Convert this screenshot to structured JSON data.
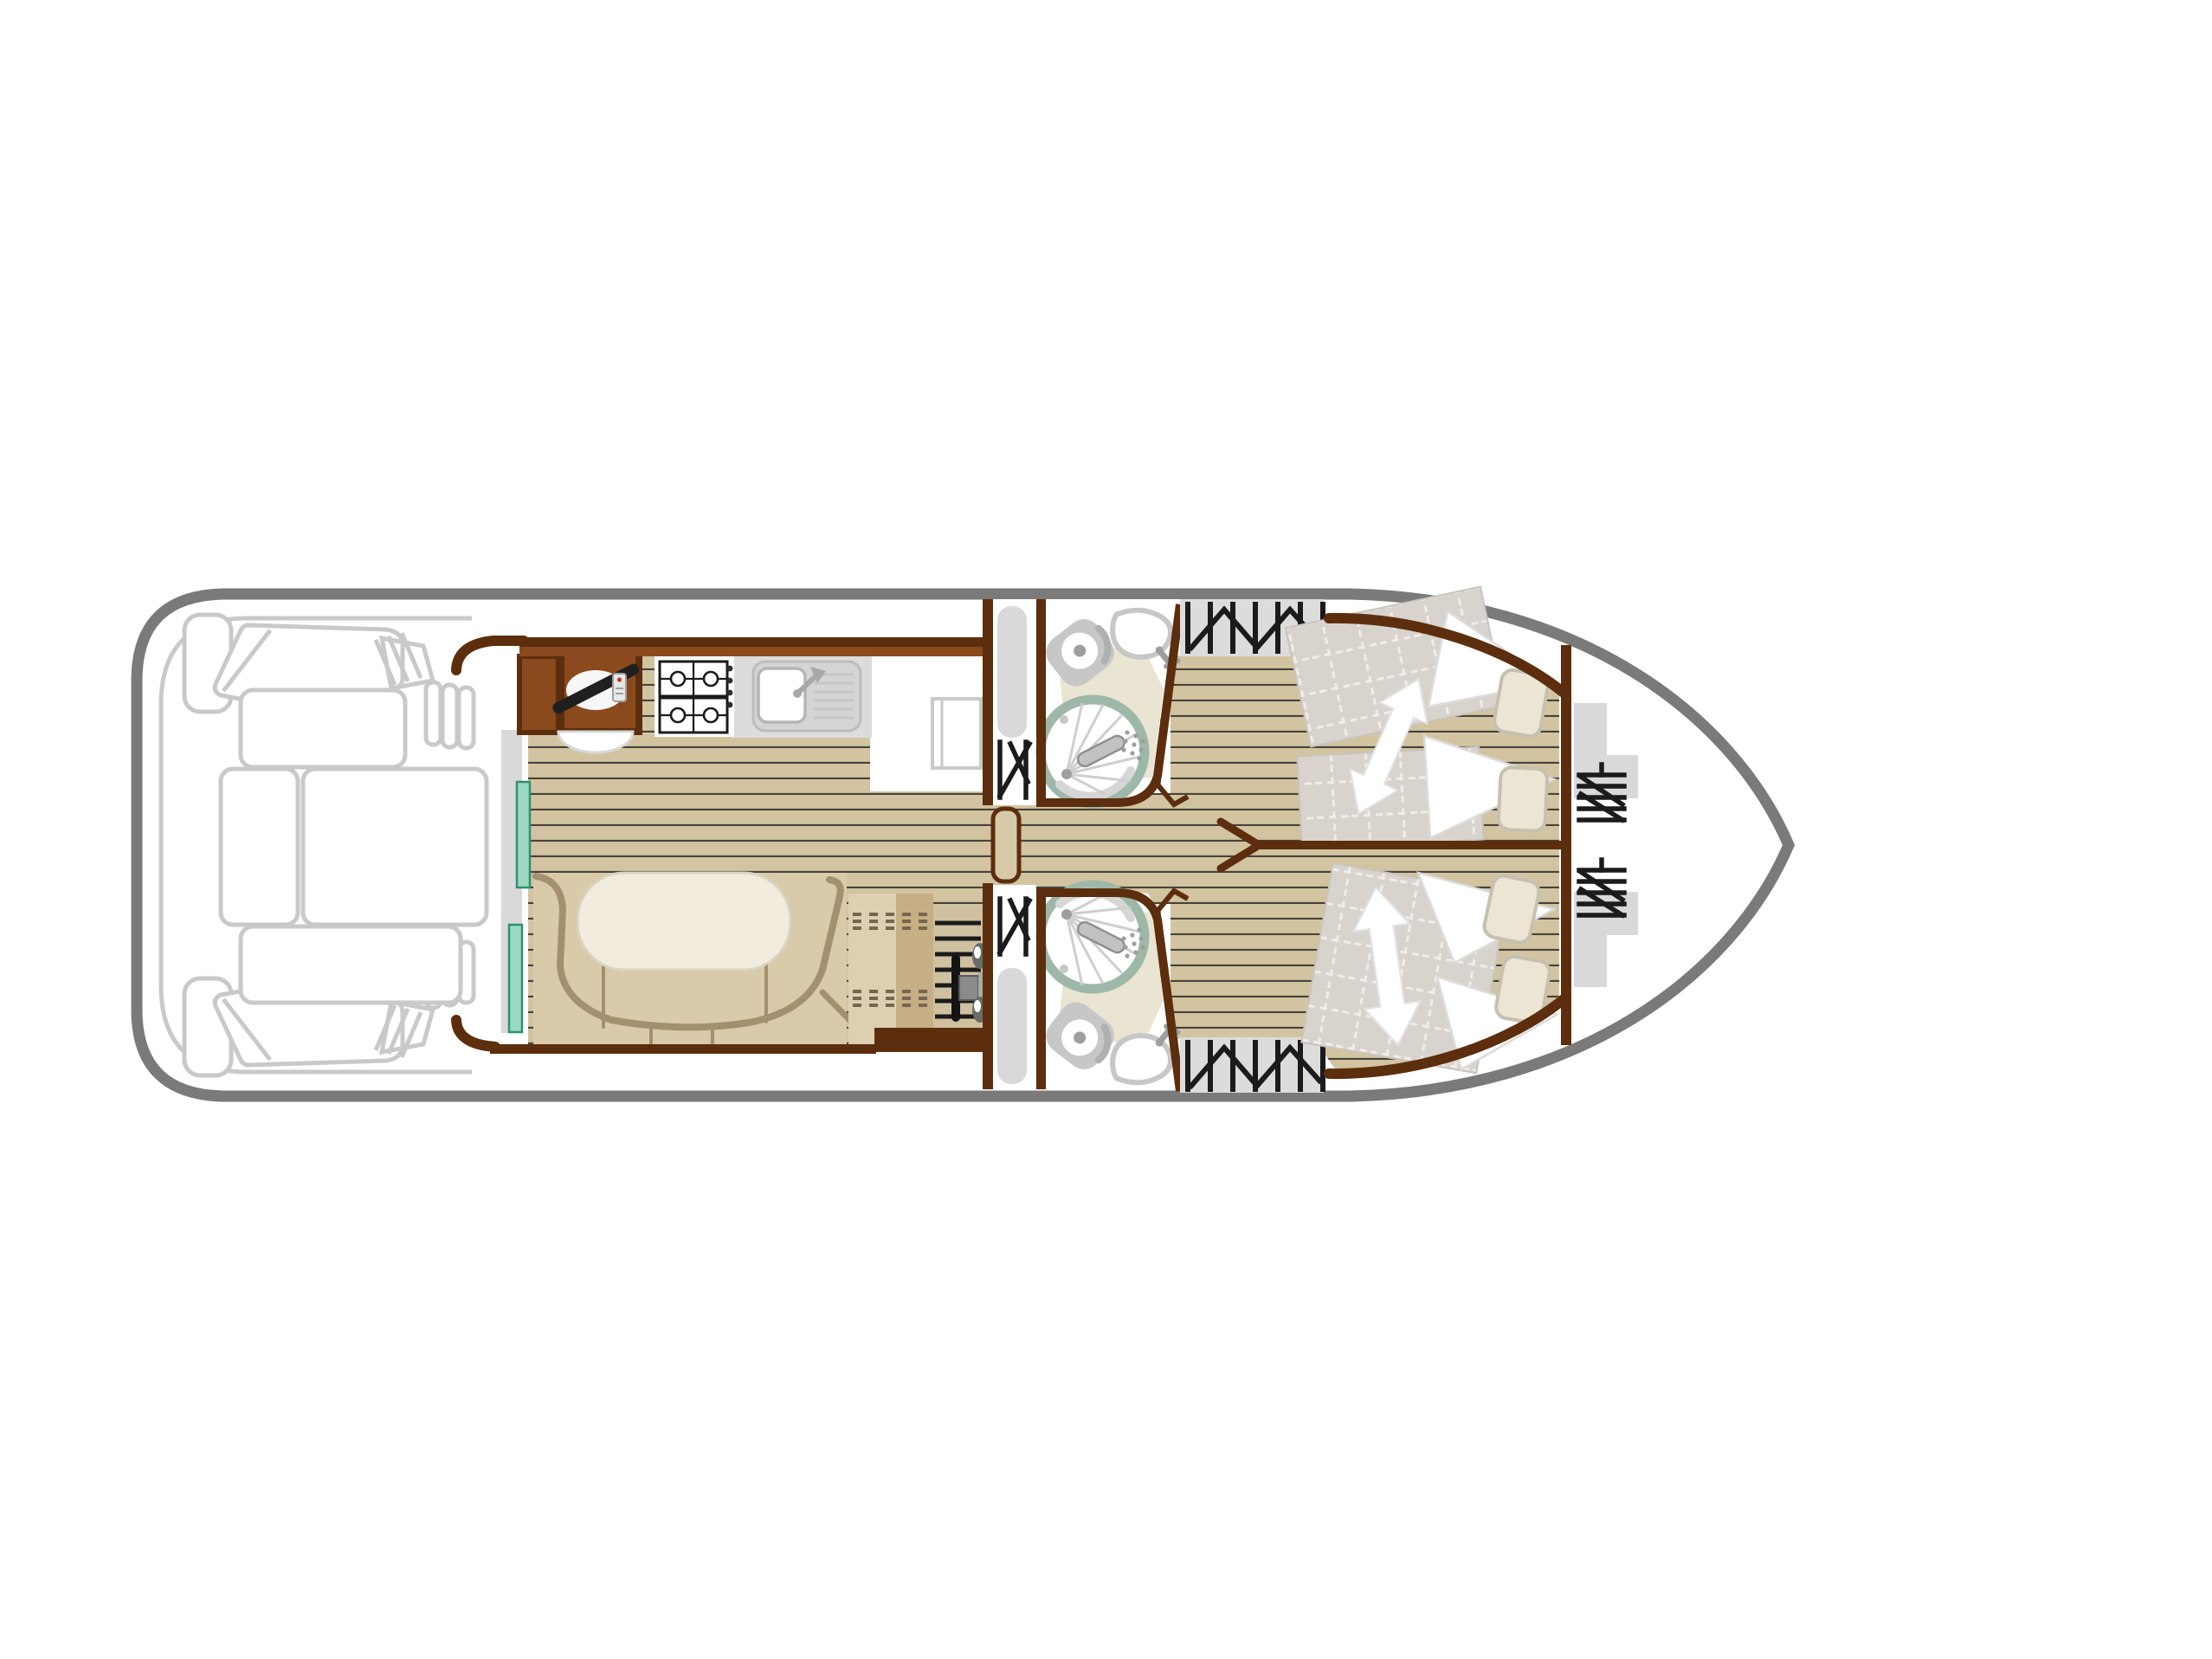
{
  "meta": {
    "title": "Canal boat deck floor plan — top-down layout, bow to the right",
    "type": "floor-plan-diagram",
    "orientation": {
      "bow": "right",
      "stern": "left"
    }
  },
  "colors": {
    "canvas": "#ffffff",
    "boat_fill": "#ffffff",
    "hull_outline": "#7a7a7a",
    "deck_outline": "#c9c9c9",
    "wall_brown": "#5c2e0d",
    "cabinet_brown": "#8a4a1e",
    "wood_floor": "#d3c4a1",
    "plank_line": "#45433a",
    "counter_gray": "#dcdcdc",
    "fixture_gray": "#c7c7c7",
    "fixture_gray_dark": "#9e9e9e",
    "shower_ring_sage": "#9db8a8",
    "shower_spoke": "#cfcfcf",
    "bath_patch_beige": "#eae4d2",
    "teal_door": "#9bd9c1",
    "teal_door_edge": "#2f8f76",
    "sofa_tan": "#d9caaa",
    "sofa_edge": "#a2906e",
    "table_cream": "#f1ecdd",
    "table_edge": "#d9d3c0",
    "sideboard_light": "#ddd0b2",
    "sideboard_dark": "#c7af85",
    "stitch_dash": "#74674f",
    "steps_bg": "#cfc0a0",
    "icon_black": "#1b1b1b",
    "mattress_gray": "#d9d3cd",
    "quilt_line": "#f0ede9",
    "pillow_cream": "#ece5d3",
    "pillow_edge": "#c6c0b1",
    "blanket_white": "#ffffff",
    "blanket_edge": "#dcdcdc",
    "wardrobe_bg": "#dcdcdc",
    "locker_gray": "#d9d9d9",
    "door_leaf_tan": "#d8c9a8",
    "arrow_white": "#ffffff",
    "arrow_edge": "#e3e3e3"
  },
  "structure": {
    "vessel": {
      "kind": "river cruiser / houseboat",
      "view": "top-down deck plan"
    },
    "areas": [
      {
        "id": "aft-deck",
        "name": "Open aft deck",
        "furniture": [
          "corner lounge seat (top)",
          "corner lounge seat (bottom)",
          "small side seat x2",
          "bench cushion x4",
          "boarding steps x2",
          "transom gate slats x2"
        ]
      },
      {
        "id": "saloon-galley",
        "name": "Saloon and galley",
        "furniture": [
          "helm console with steering wheel and remote",
          "helm seat",
          "side cabinet",
          "two-burner hob x2 with control knobs",
          "sink with drainboard and faucet",
          "worktop",
          "fridge / locker",
          "sliding patio door (teal panels)",
          "U-shaped sofa",
          "oval dinette table",
          "sideboard with stitched cushions",
          "companionway steps with handrail and engine control"
        ]
      },
      {
        "id": "shower-room-top",
        "name": "Shower room (port)",
        "furniture": [
          "toilet",
          "washbasin with faucet",
          "round shower cabin with shower head",
          "hanging wardrobe",
          "sliding door panel",
          "hinged door with swing marks"
        ]
      },
      {
        "id": "shower-room-bottom",
        "name": "Shower room (starboard)",
        "furniture": [
          "toilet",
          "washbasin with faucet",
          "round shower cabin with shower head",
          "hanging wardrobe",
          "sliding door panel",
          "hinged door with swing marks"
        ]
      },
      {
        "id": "cabin-top",
        "name": "Forward cabin (port)",
        "furniture": [
          "sliding twin mattresses (quilted)",
          "duvet folds",
          "pillow x2",
          "bed-conversion double arrow",
          "hanging wardrobe"
        ]
      },
      {
        "id": "cabin-bottom",
        "name": "Forward cabin (starboard)",
        "furniture": [
          "double mattress (quilted)",
          "duvet folds",
          "pillow x2",
          "bed-conversion double arrow",
          "hanging wardrobe"
        ]
      },
      {
        "id": "bow",
        "name": "Bow compartment",
        "furniture": [
          "storage locker shelf x2",
          "hanging rail icon x2"
        ]
      },
      {
        "id": "corridor",
        "name": "Central corridor",
        "furniture": [
          "open door leaf",
          "partition wall with fork jamb"
        ]
      }
    ]
  }
}
